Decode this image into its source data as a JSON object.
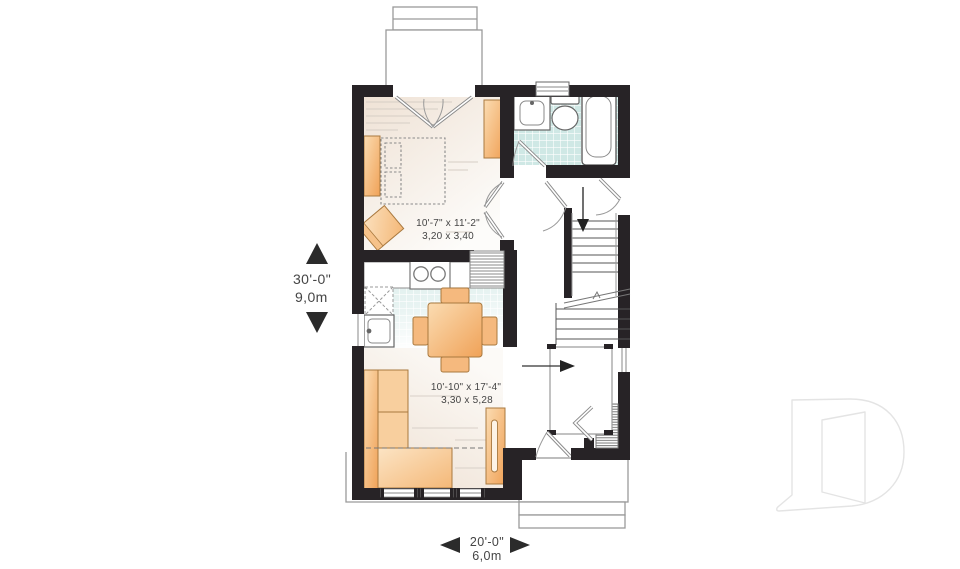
{
  "plan": {
    "dimensions": {
      "height": {
        "imperial": "30'-0\"",
        "metric": "9,0m"
      },
      "width": {
        "imperial": "20'-0\"",
        "metric": "6,0m"
      }
    },
    "rooms": {
      "bedroom": {
        "imperial": "10'-7\" x 11'-2\"",
        "metric": "3,20 x 3,40"
      },
      "living": {
        "imperial": "10'-10\" x 17'-4\"",
        "metric": "3,30 x 5,28"
      }
    },
    "colors": {
      "wall": "#272326",
      "furniture_orange": "#f3a960",
      "tile_teal": "#cfe8e5",
      "outline_gray": "#9a9a9a",
      "text_gray": "#454545",
      "watermark_gray": "#e4e4e4"
    },
    "icons": [
      "bed-icon",
      "dresser-icon",
      "armchair-icon",
      "bathtub-icon",
      "toilet-icon",
      "vanity-sink-icon",
      "stove-icon",
      "fridge-icon",
      "kitchen-sink-icon",
      "dining-table-icon",
      "chair-icon",
      "sofa-icon",
      "tv-unit-icon",
      "stairs-icon",
      "down-arrow-icon",
      "entry-arrow-icon",
      "door-swing-icon",
      "bifold-door-icon",
      "window-icon",
      "closet-icon",
      "porch-icon",
      "drummond-d-logo"
    ]
  }
}
